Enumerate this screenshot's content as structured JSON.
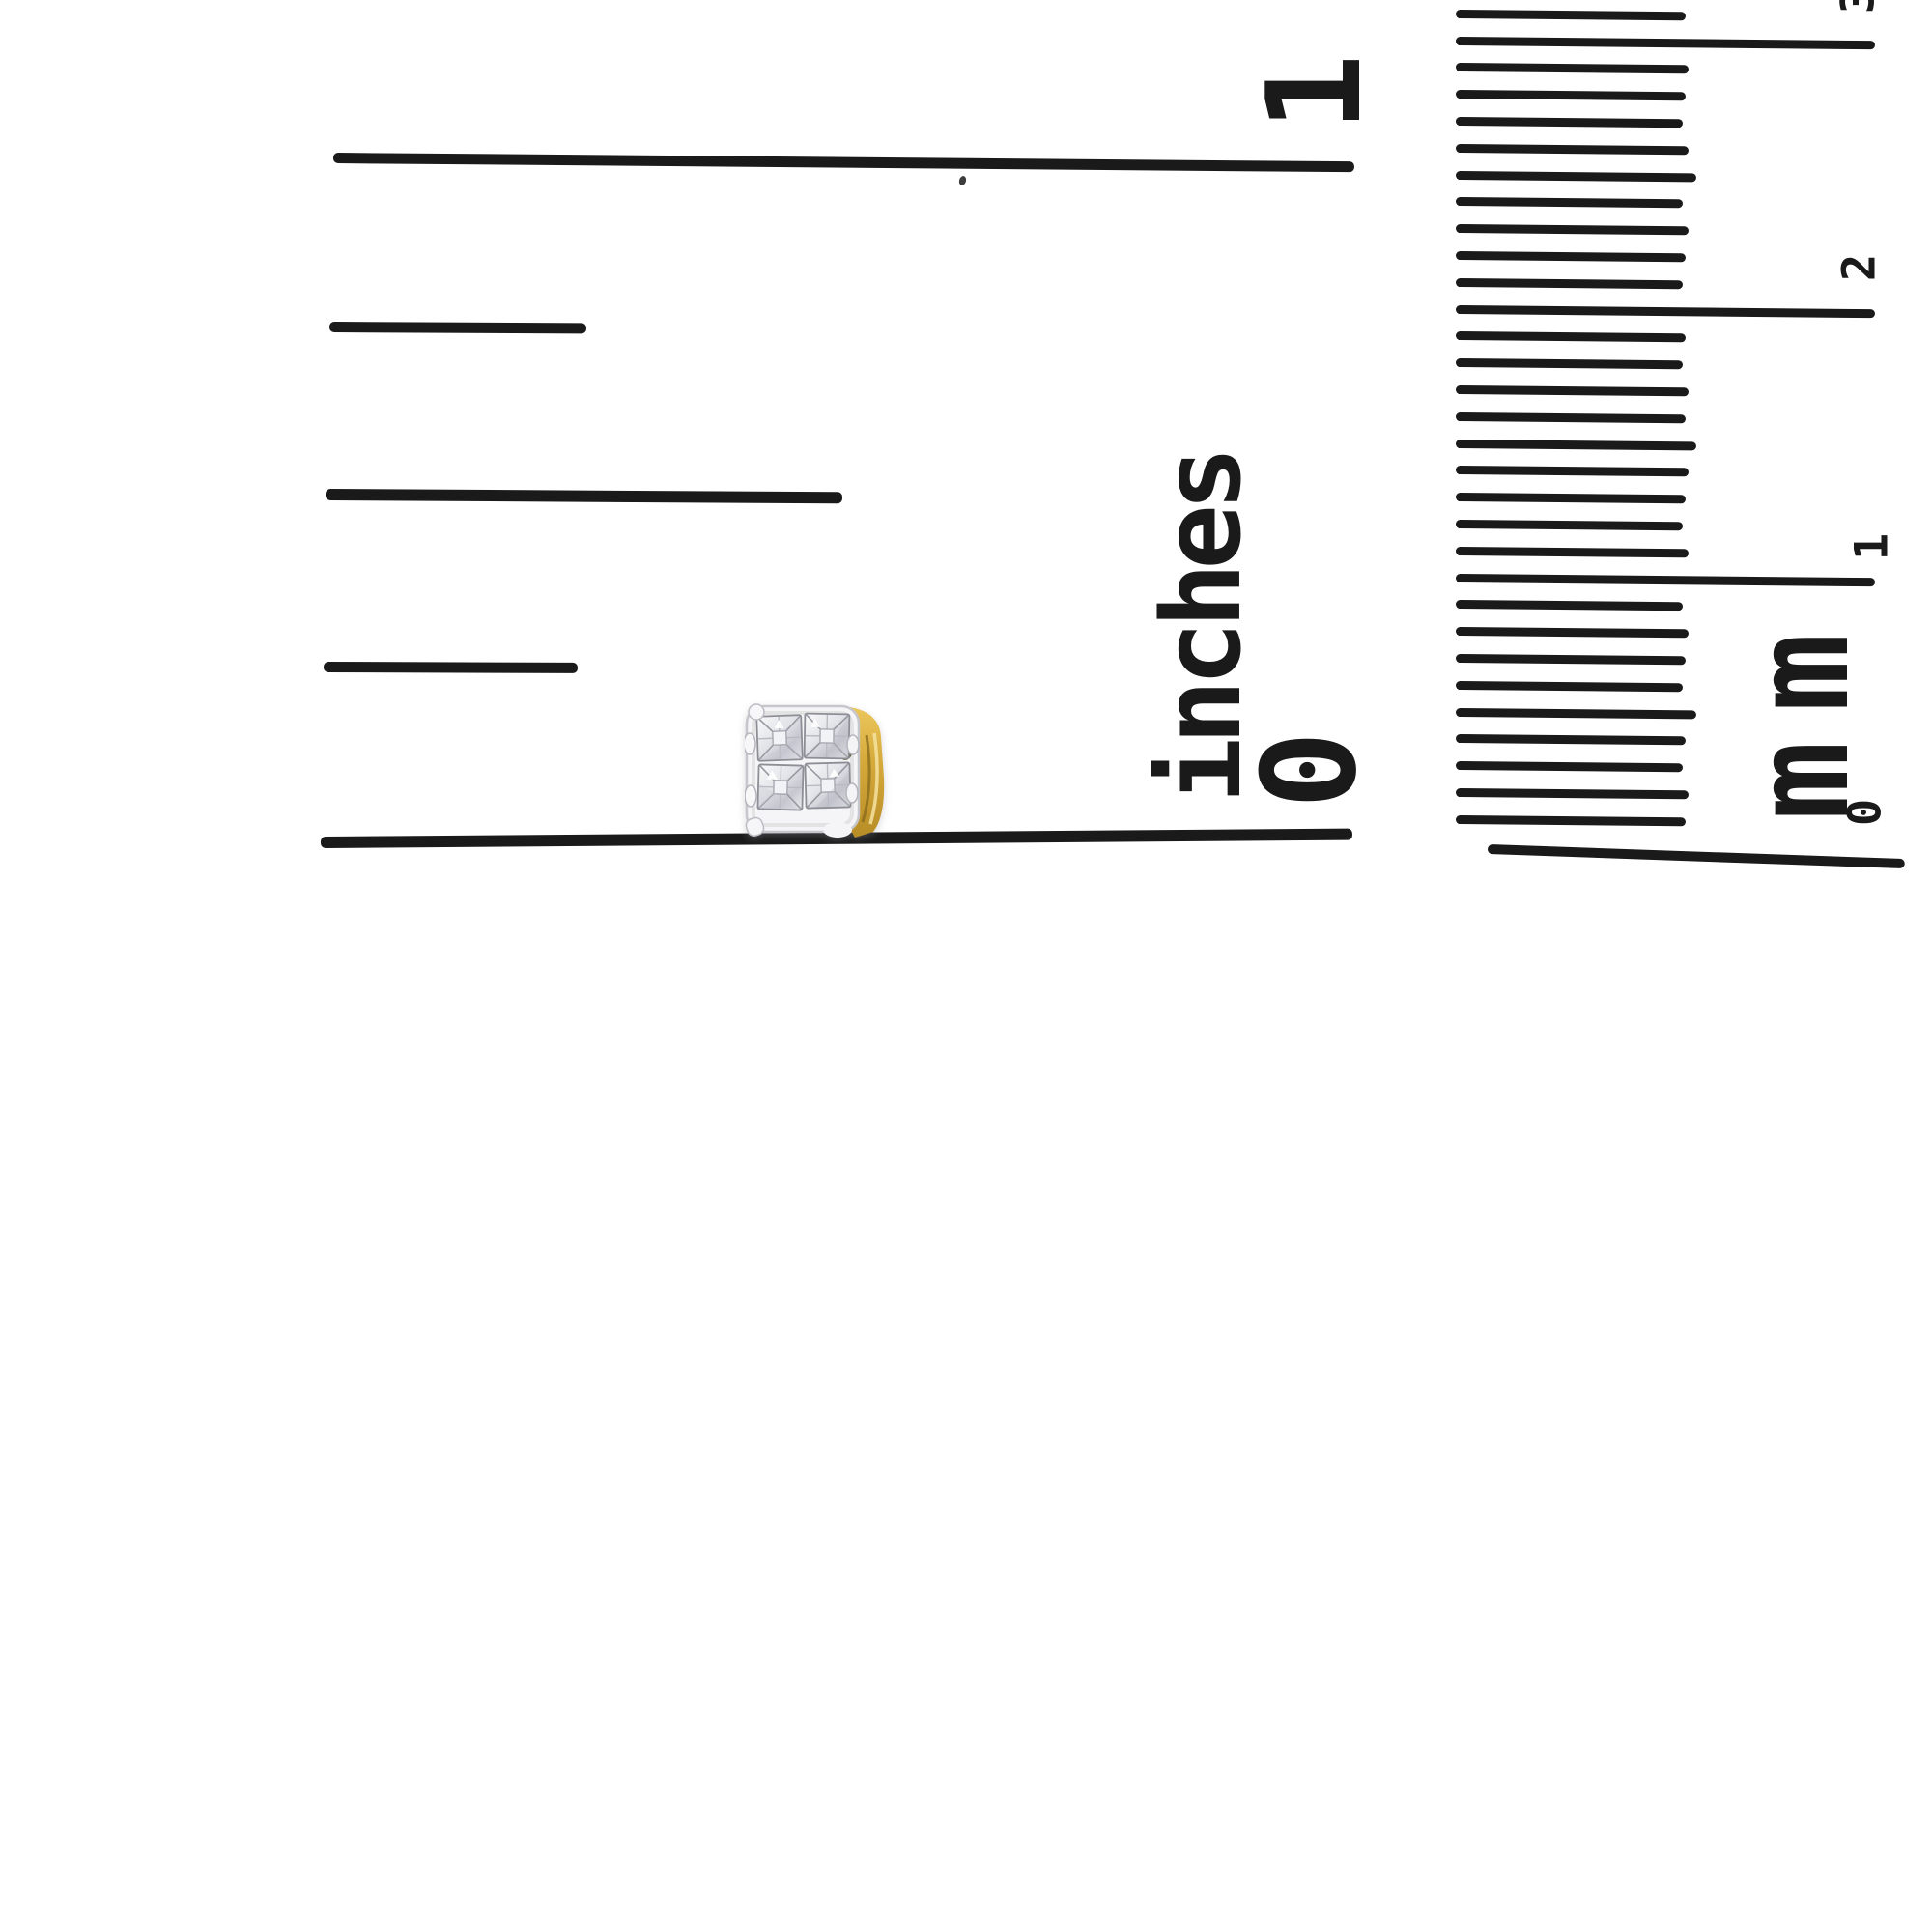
{
  "photo": {
    "subject": "diamond cluster stud earring photographed against inch and millimeter ruler for scale",
    "background": "#ffffff",
    "ink_color": "#1a1a1a"
  },
  "inch_ruler": {
    "unit_label": "inches",
    "one_label": "1",
    "zero_label": "0",
    "tick_values": [
      "1",
      "3/4",
      "1/2",
      "1/4",
      "0"
    ]
  },
  "mm_ruler": {
    "unit_label": "mm",
    "cm_labels": [
      "3",
      "2",
      "1",
      "0"
    ],
    "mm_tick_count": 31,
    "medium_tick_every": 5,
    "long_tick_every": 10
  },
  "earring": {
    "stone_count": 4,
    "stone_cut": "princess",
    "colors": {
      "metal_white": "#f5f5f7",
      "metal_edge": "#c6c6cd",
      "stone_light": "#fafafb",
      "stone_mid": "#d9dade",
      "stone_deep": "#c6c7cf",
      "facet_line": "#8e8e97",
      "gold_light": "#ecc75d",
      "gold_mid": "#d4a839",
      "gold_dark": "#a8811f",
      "accent_olive": "#6d6a4c",
      "accent_dark_olive": "#585538"
    }
  }
}
